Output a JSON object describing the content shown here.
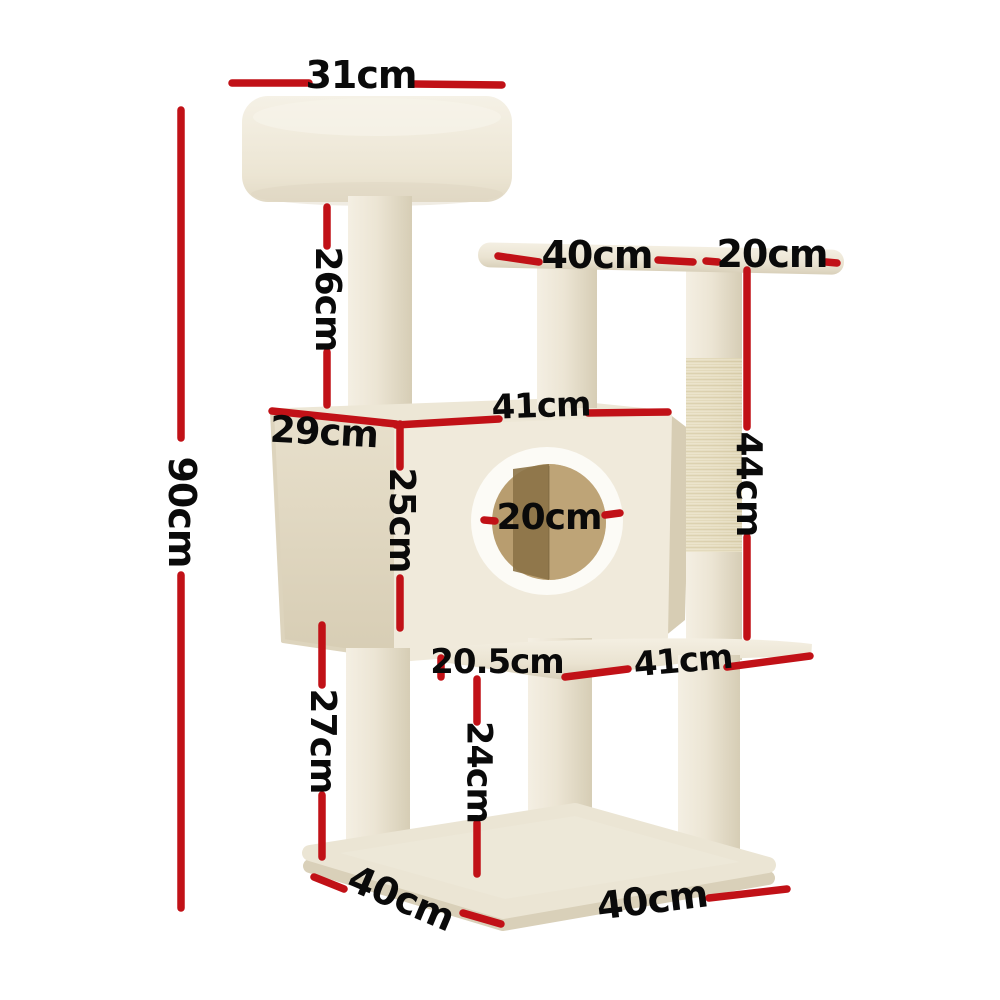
{
  "page": {
    "background_color": "#ffffff",
    "content": "cat tree scratching post dimension diagram"
  },
  "annotation": {
    "line_color": "#c11117",
    "text_color": "#0a0a0a",
    "unit": "cm"
  },
  "product_colors": {
    "plush": "#f0ead9",
    "plush_shade": "#d8cfb8",
    "sisal": "#eae2c7",
    "hole_rim": "#fcfbf6",
    "hole_interior": "#b89d6f"
  },
  "dimensions": {
    "top_platform_width": {
      "label": "31cm"
    },
    "top_post_height": {
      "label": "26cm"
    },
    "mid_platform_length": {
      "label": "40cm"
    },
    "mid_platform_overhang": {
      "label": "20cm"
    },
    "total_height": {
      "label": "90cm"
    },
    "condo_width": {
      "label": "41cm"
    },
    "condo_depth": {
      "label": "29cm"
    },
    "condo_height": {
      "label": "25cm"
    },
    "hole_diameter": {
      "label": "20cm"
    },
    "scratch_post_height": {
      "label": "44cm"
    },
    "lower_platform_offset": {
      "label": "20.5cm"
    },
    "lower_platform_length": {
      "label": "41cm"
    },
    "lower_post_height": {
      "label": "27cm"
    },
    "platform_to_base_height": {
      "label": "24cm"
    },
    "base_depth": {
      "label": "40cm"
    },
    "base_width": {
      "label": "40cm"
    }
  }
}
